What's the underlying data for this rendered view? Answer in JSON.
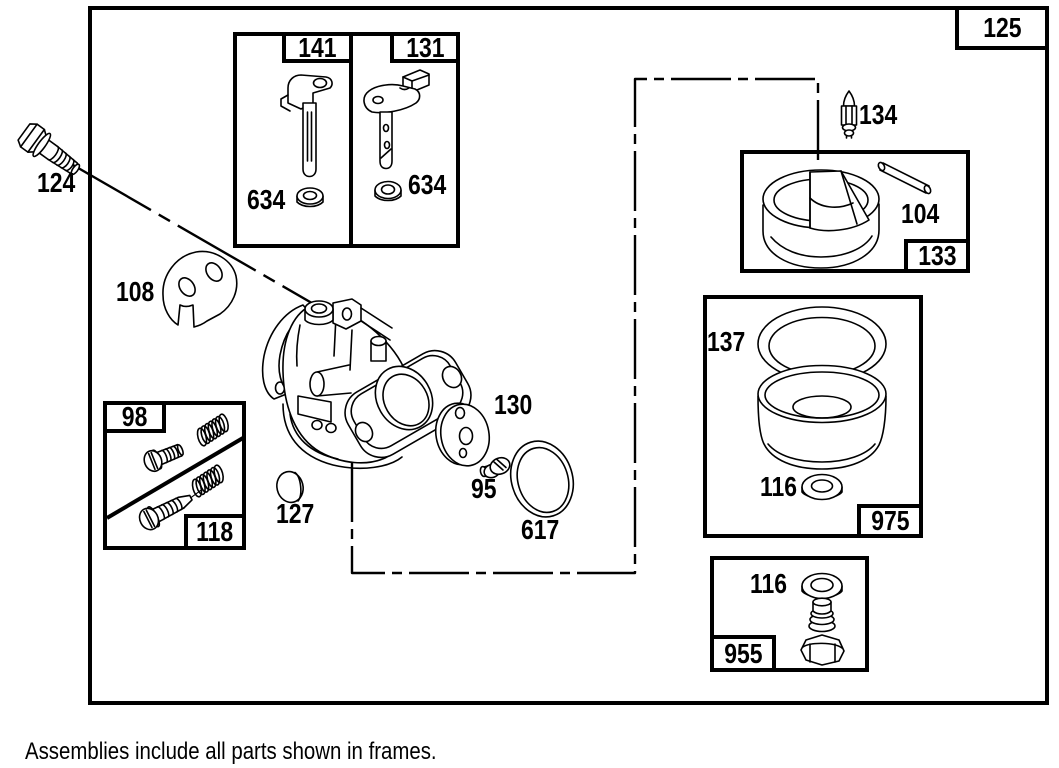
{
  "note": "Assemblies include all parts shown in frames.",
  "main_frame": {
    "label": "125"
  },
  "frames": {
    "shaft141": {
      "label": "141",
      "washer": "634"
    },
    "shaft131": {
      "label": "131",
      "washer": "634"
    },
    "float133": {
      "label": "133",
      "float": "104"
    },
    "bowl975": {
      "label": "975",
      "gasket": "137",
      "washer": "116"
    },
    "nut955": {
      "label": "955",
      "washer": "116"
    },
    "mixture": {
      "upper": "98",
      "lower": "118"
    }
  },
  "parts": {
    "bolt": "124",
    "bracket": "108",
    "needle": "134",
    "plate": "130",
    "screw": "95",
    "oring": "617",
    "seal": "127"
  }
}
